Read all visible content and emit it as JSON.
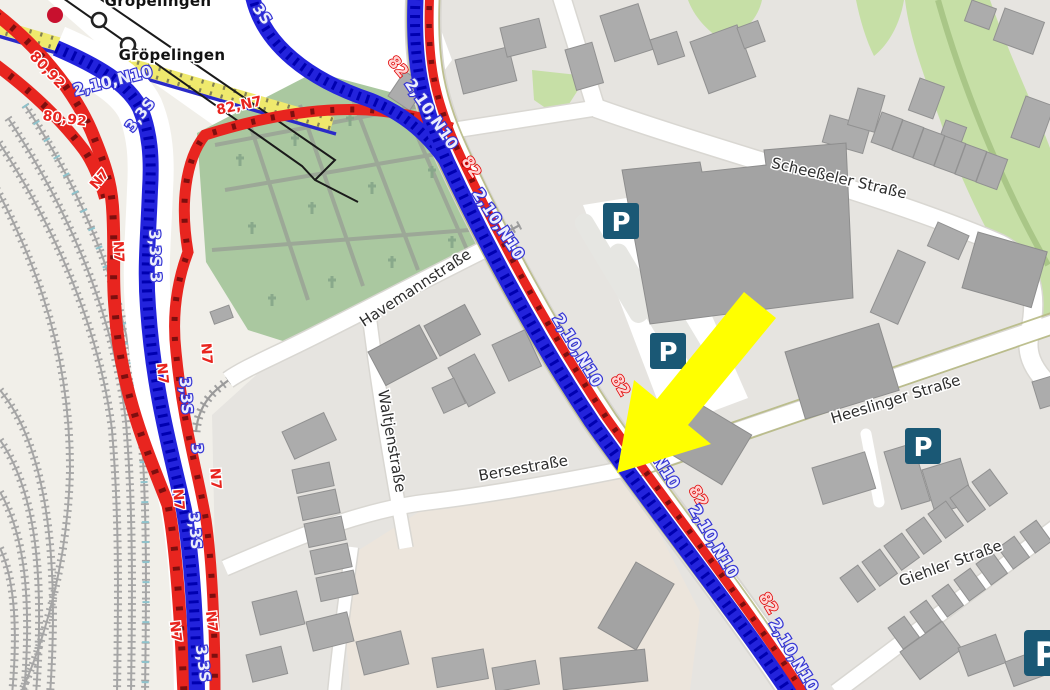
{
  "place": {
    "groepelingen": "Gröpelingen"
  },
  "streets": {
    "scheesseler": "Scheeßeler Straße",
    "havemann": "Havemannstraße",
    "waltjen": "Waltjenstraße",
    "berse": "Bersestraße",
    "heeslinger": "Heeslinger Straße",
    "giehler": "Giehler Straße"
  },
  "route_text": {
    "r80_92": "80,92",
    "r82_n7": "82,N7",
    "n7": "N7",
    "r82": "82",
    "b2_10_n10": "2,10,N10",
    "b3_3s": "3,3S",
    "b3_3s_3": "3,3S 3",
    "b3": "3",
    "b3s": "3S"
  },
  "parking": {
    "symbol": "P"
  },
  "annotations": {
    "highlight_arrow": "yellow arrow pointing at Bersestraße / main road intersection"
  },
  "colors": {
    "route_red": "#e8251f",
    "route_red_dark": "#7d0f0f",
    "route_blue": "#2323dc",
    "route_blue_dark": "#0000b0",
    "arrow_yellow": "#ffff00",
    "parking_blue": "#1a5875",
    "cemetery_green": "#aac8a0",
    "grass_green": "#c6dfa6",
    "building_gray": "#acacac",
    "road_white": "#ffffff",
    "platform_yellow": "#efe96d",
    "land_beige": "#f1efe9",
    "urban_gray": "#e6e4e0"
  }
}
